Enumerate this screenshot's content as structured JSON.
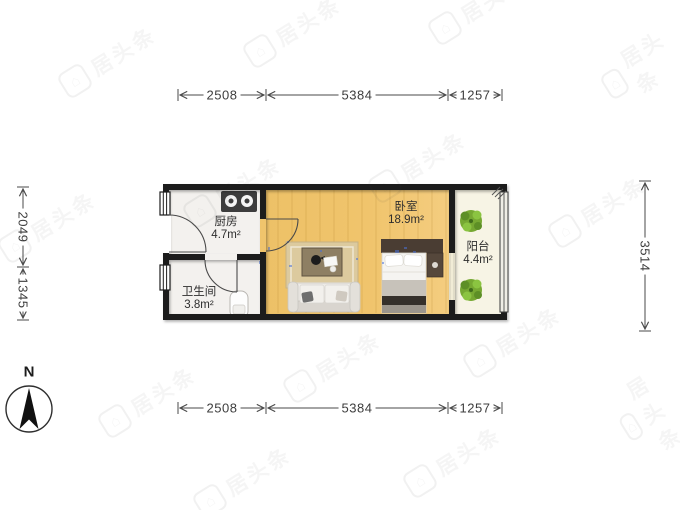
{
  "plan": {
    "rooms": [
      {
        "name": "厨房",
        "area": "4.7m²"
      },
      {
        "name": "卫生间",
        "area": "3.8m²"
      },
      {
        "name": "卧室",
        "area": "18.9m²"
      },
      {
        "name": "阳台",
        "area": "4.4m²"
      }
    ],
    "dimensions": {
      "top": [
        "2508",
        "5384",
        "1257"
      ],
      "bottom": [
        "2508",
        "5384",
        "1257"
      ],
      "left": [
        "2049",
        "1345"
      ],
      "right": [
        "3514"
      ]
    },
    "compass": {
      "label": "N"
    },
    "watermark": {
      "text": "居头条"
    },
    "colors": {
      "wall": "#1d1d1d",
      "wood_floor": "#f0c46c",
      "tile_floor": "#f3f1ee",
      "balcony_floor": "#f7f4e5",
      "plant_green": "#76a832",
      "dimension_text": "#3d3d3d"
    }
  }
}
